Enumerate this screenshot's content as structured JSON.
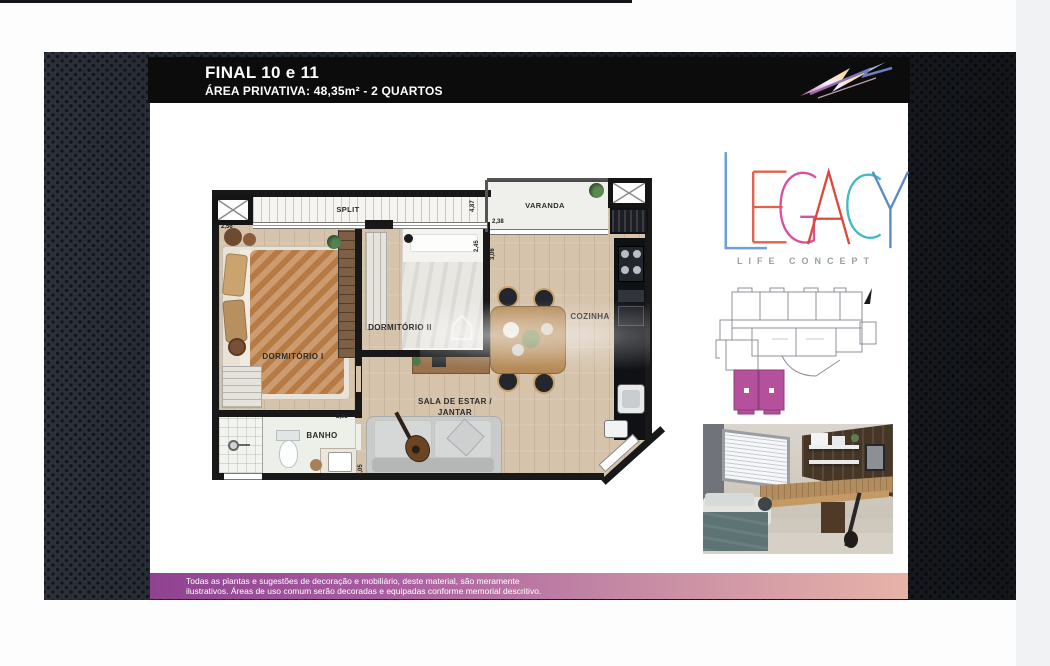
{
  "header": {
    "title": "FINAL 10 e 11",
    "subtitle": "ÁREA PRIVATIVA: 48,35m² - 2 QUARTOS"
  },
  "brand": {
    "name": "LEGACY",
    "tagline": "LIFE CONCEPT",
    "letter_colors": [
      "#6f9fd8",
      "#e2614d",
      "#d8509f",
      "#dd4a3c",
      "#46b8c6",
      "#5b8ac4"
    ]
  },
  "floor_plan": {
    "room_labels": {
      "split": "SPLIT",
      "varanda": "VARANDA",
      "dormitorio_1": "DORMITÓRIO I",
      "dormitorio_2": "DORMITÓRIO II",
      "cozinha": "COZINHA",
      "sala_line1": "SALA DE ESTAR /",
      "sala_line2": "JANTAR",
      "banho": "BANHO"
    },
    "dimension_labels": [
      "2,56",
      "4,87",
      "2,38",
      "2,45",
      "3,06",
      "2,95",
      "4,05"
    ]
  },
  "key_plan": {
    "highlight_color": "#b4509c",
    "highlighted_units": "10 e 11"
  },
  "disclaimer": {
    "line1": "Todas as plantas e sugestões de decoração e mobiliário, deste material, são meramente",
    "line2": "ilustrativos. Áreas de uso comum serão decoradas e equipadas conforme memorial descritivo."
  },
  "colors": {
    "header_bg": "#0c0c0c",
    "stage_bg": "#2b3039",
    "wood_floor": "#d5c3ac",
    "disclaimer_gradient_start": "#8f4290",
    "disclaimer_gradient_end": "#e7b3a8",
    "keyplan_magenta": "#b4509c"
  }
}
